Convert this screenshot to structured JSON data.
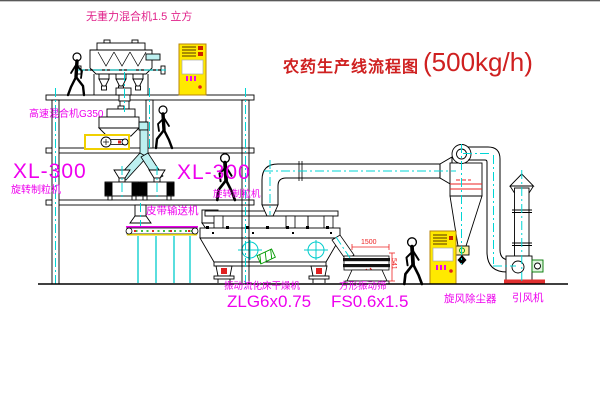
{
  "title": {
    "name": "农药生产线流程图",
    "capacity": "(500kg/h)"
  },
  "equipment_labels": {
    "gravity_free_mixer": "无重力混合机1.5 立方",
    "high_speed_mixer": "高速混合机G350",
    "granulator_left": {
      "model": "XL-300",
      "name": "旋转制粒机"
    },
    "granulator_right": {
      "model": "XL-300",
      "name": "旋转制粒机"
    },
    "belt_conveyor": "皮带输送机",
    "fluid_bed_dryer": {
      "name": "振动流化床干燥机",
      "model": "ZLG6x0.75"
    },
    "square_screen": {
      "name": "方形振动筛",
      "model": "FS0.6x1.5"
    },
    "cyclone": "旋风除尘器",
    "fan": "引风机"
  },
  "dimensions": {
    "screen_length": "1500",
    "screen_height": "541"
  },
  "colors": {
    "label_magenta": "#ee00ee",
    "title_red": "#cf2020",
    "dimension_red": "#ee2222",
    "centerline_cyan": "#00d5d5",
    "cabinet_yellow": "#ffe900",
    "accent_green": "#009900"
  }
}
